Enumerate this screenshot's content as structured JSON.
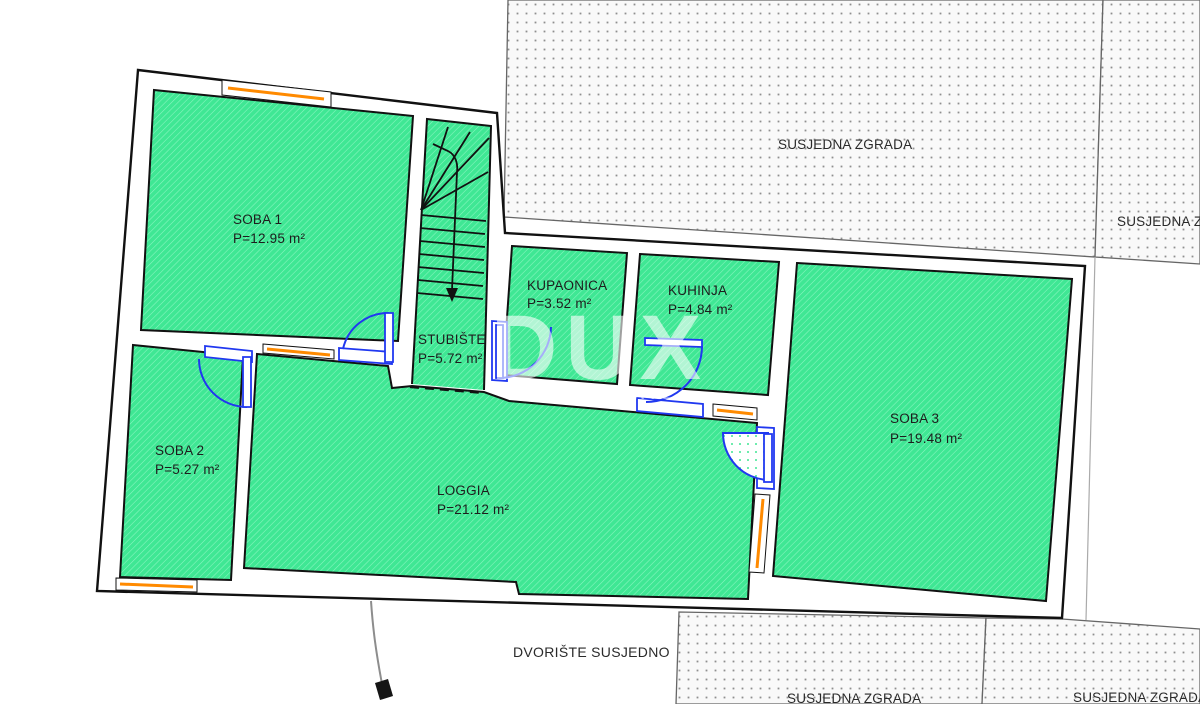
{
  "site": {
    "neighbor_top": "SUSJEDNA ZGRADA",
    "neighbor_right_clipped": "SUSJEDNA Z",
    "neighbor_bottom_mid": "SUSJEDNA ZGRADA",
    "neighbor_bottom_right": "SUSJEDNA ZGRADA",
    "courtyard": "DVORIŠTE SUSJEDNO"
  },
  "watermark": {
    "brand": "DUX",
    "tagline": "REAL ESTATE"
  },
  "rooms": [
    {
      "name": "SOBA 1",
      "area": "P=12.95 m²"
    },
    {
      "name": "SOBA 2",
      "area": "P=5.27 m²"
    },
    {
      "name": "SOBA 3",
      "area": "P=19.48 m²"
    },
    {
      "name": "KUPAONICA",
      "area": "P=3.52 m²"
    },
    {
      "name": "KUHINJA",
      "area": "P=4.84 m²"
    },
    {
      "name": "STUBIŠTE",
      "area": "P=5.72 m²"
    },
    {
      "name": "LOGGIA",
      "area": "P=21.12 m²"
    }
  ],
  "colors": {
    "room_fill": "#3FE794",
    "door_blue": "#2038F0",
    "window_orange": "#FF8A00",
    "wall_black": "#111111"
  }
}
